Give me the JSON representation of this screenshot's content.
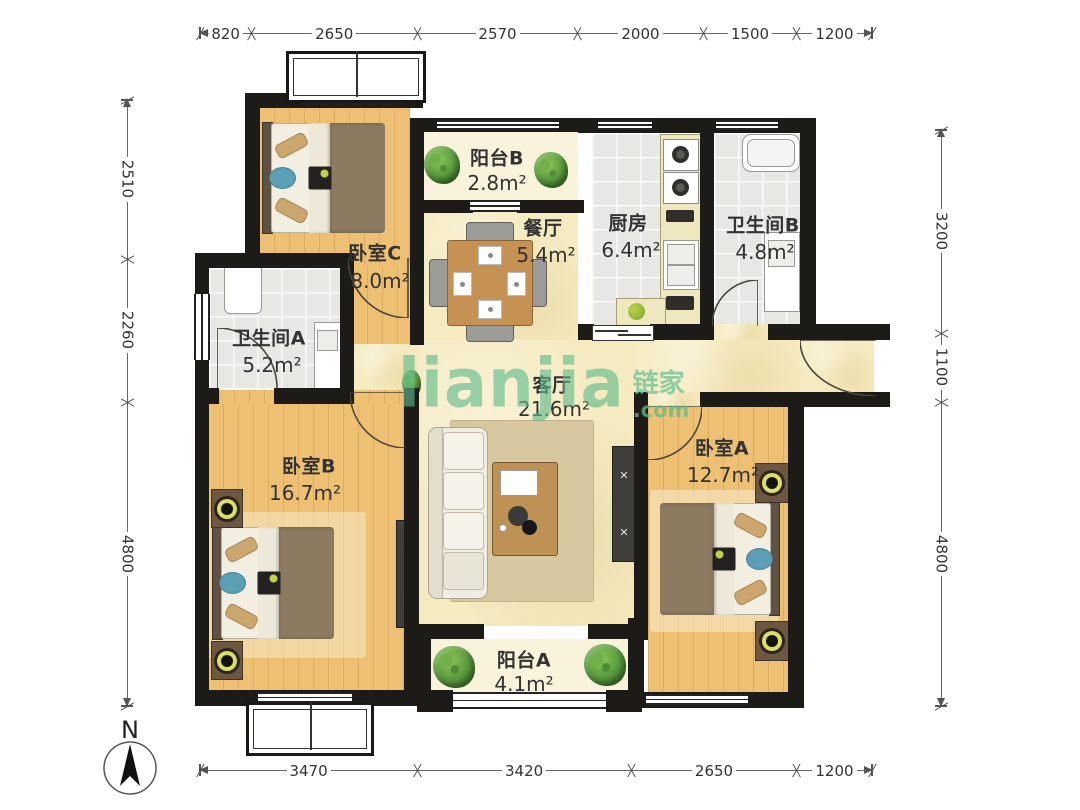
{
  "watermark": {
    "latin": "lianjia",
    "cn": "链家",
    "com": ".com"
  },
  "compass": {
    "label": "N"
  },
  "dimensions": {
    "top": [
      "820",
      "2650",
      "2570",
      "2000",
      "1500",
      "1200"
    ],
    "bottom": [
      "3470",
      "3420",
      "2650",
      "1200"
    ],
    "left": [
      "2510",
      "2260",
      "4800"
    ],
    "right": [
      "3200",
      "1100",
      "4800"
    ]
  },
  "rooms": [
    {
      "id": "bedroom-c",
      "name": "卧室C",
      "area": "8.0m²"
    },
    {
      "id": "balcony-b",
      "name": "阳台B",
      "area": "2.8m²"
    },
    {
      "id": "dining-room",
      "name": "餐厅",
      "area": "5.4m²"
    },
    {
      "id": "kitchen",
      "name": "厨房",
      "area": "6.4m²"
    },
    {
      "id": "bathroom-b",
      "name": "卫生间B",
      "area": "4.8m²"
    },
    {
      "id": "bathroom-a",
      "name": "卫生间A",
      "area": "5.2m²"
    },
    {
      "id": "living-room",
      "name": "客厅",
      "area": "21.6m²"
    },
    {
      "id": "bedroom-b",
      "name": "卧室B",
      "area": "16.7m²"
    },
    {
      "id": "bedroom-a",
      "name": "卧室A",
      "area": "12.7m²"
    },
    {
      "id": "balcony-a",
      "name": "阳台A",
      "area": "4.1m²"
    }
  ],
  "colors": {
    "wall": "#1C1B17",
    "wood_floor": "#EDC073",
    "tile_floor": "#E7E7E4",
    "hall_floor": "#F5EAC0",
    "balcony_floor": "#FAF3DC",
    "watermark_green": "#5FBB8C",
    "dimension_text": "#333333"
  }
}
